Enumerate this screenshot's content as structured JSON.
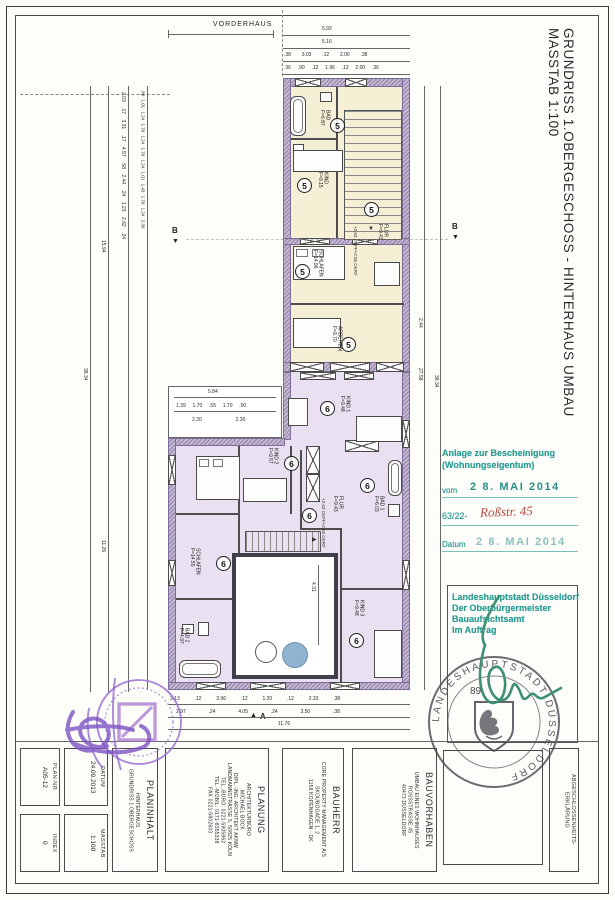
{
  "sheet": {
    "title": "GRUNDRISS 1.OBERGESCHOSS - HINTERHAUS UMBAU",
    "scale": "MASSTAB 1:100",
    "vorderhaus": "VORDERHAUS"
  },
  "rooms5": [
    {
      "no": "5",
      "name": "BAD",
      "area": "F=6.87"
    },
    {
      "no": "5",
      "name": "KIND",
      "area": "F=9.15"
    },
    {
      "no": "5",
      "name": "SCHLAFEN",
      "area": "F=14.96"
    },
    {
      "no": "5",
      "name": "FLUR",
      "area": "F=9.43"
    },
    {
      "no": "5",
      "name": "ARBEITEN",
      "area": "F=9.70"
    }
  ],
  "rooms6": [
    {
      "no": "6",
      "name": "KIND 1",
      "area": "F=9.48"
    },
    {
      "no": "6",
      "name": "KIND 2",
      "area": "F=9.57"
    },
    {
      "no": "6",
      "name": "BAD 1",
      "area": "F=6.03"
    },
    {
      "no": "6",
      "name": "FLUR",
      "area": "F=9.43"
    },
    {
      "no": "6",
      "name": "SCHLAFEN",
      "area": "F=14.55"
    },
    {
      "no": "6",
      "name": "BAD 2",
      "area": "F=4.97"
    },
    {
      "no": "6",
      "name": "KIND 3",
      "area": "F=9.48"
    }
  ],
  "notes": {
    "level_line1": "+2.63 OKFF",
    "level_line2": "+2.55 OKRF",
    "section_a": "A",
    "section_b": "B"
  },
  "dims": {
    "top_total": "5.92",
    "top_2": "5.16",
    "top_3": ".38  3.03  .12  2.00  .38",
    "top_4": ".36  .90  .12  1.96  .12  2.00  .36",
    "bottom_1": "3.13  .12  3.96  .12  1.20  .12  2.33  .38",
    "bottom_2": "2.97  .24  4.05  .24  3.50  .38",
    "bottom_total": "11.76",
    "left_a": ".80 1.01 1.24 1.70 1.24 1.70 1.24 1.01 1.43 1.70 1.24 2.30",
    "left_b": "2.03 .17 3.31 .17 4.57 .58 2.44 .24 1.23 2.62 .24",
    "left_c1": "15.94",
    "left_c2": "11.26",
    "left_total": "38.34",
    "right_1": "2.44",
    "right_2": "27.58",
    "right_total": "38.34",
    "inner_total": "5.84",
    "inner_parts": "1.39  1.70  .55  1.70  .50",
    "inner_parts2": "2.30          2.30",
    "courtyard_h": "4.31"
  },
  "stamp": {
    "line1": "Anlage zur Bescheinigung",
    "line2": "(Wohnungseigentum)",
    "vom_label": "vom",
    "vom_date": "2 8. MAI 2014",
    "file_no": "63/22-",
    "file_hand": "Roßstr. 45",
    "datum_label": "Datum",
    "datum_date": "2 8. MAI 2014",
    "auth1": "Landeshauptstadt Düsseldorf",
    "auth2": "Der Oberbürgermeister",
    "auth3": "Bauaufsichtsamt",
    "auth4": "Im Auftrag"
  },
  "seal": {
    "ring": "LANDESHAUPTSTADT DÜSSELDORF",
    "number": "89"
  },
  "titleblock": {
    "plannr_label": "PLAN-NR.",
    "plannr_value": "A05-12",
    "index_label": "INDEX",
    "index_value": "0",
    "datum_label": "DATUM",
    "datum_value": "24.09.2013",
    "masstab_label": "MASSTAB",
    "masstab_value": "1:100",
    "planinhalt_label": "PLANINHALT",
    "planinhalt_1": "HINTERHAUS",
    "planinhalt_2": "GRUNDRISS 1.OBERGESCHOSS",
    "planung_label": "PLANUNG",
    "planung_1": "ARCHITEKTURBÜRO",
    "planung_2": "MICHAEL BOCK",
    "planung_3": "DIPL.-ING. ARCHITEKT AKNW",
    "planung_4": "LANDMANNSTRASSE 5, 50825 KÖLN",
    "planung_5": "TEL.-BÜRO: 0221-5905862",
    "planung_6": "TEL.-MOBIL: 0171-8355338",
    "planung_7": "FAX 0221-5802603",
    "bauherr_label": "BAUHERR",
    "bauherr_1": "CORE PROPERTY MANAGEMENT A/S",
    "bauherr_2": "SKOUBOGADE 1, 2",
    "bauherr_3": "1158 KOPENHAGEN - DK",
    "bauvorhaben_label": "BAUVORHABEN",
    "bauvorhaben_1": "UMBAU EINES WOHNHAUSES",
    "bauvorhaben_2": "ROSSSTRASSE 45",
    "bauvorhaben_3": "40473 DÜSSELDORF",
    "erkl_1": "ABGESCHLOSSENHEITS-",
    "erkl_2": "ERKLÄRUNG"
  }
}
